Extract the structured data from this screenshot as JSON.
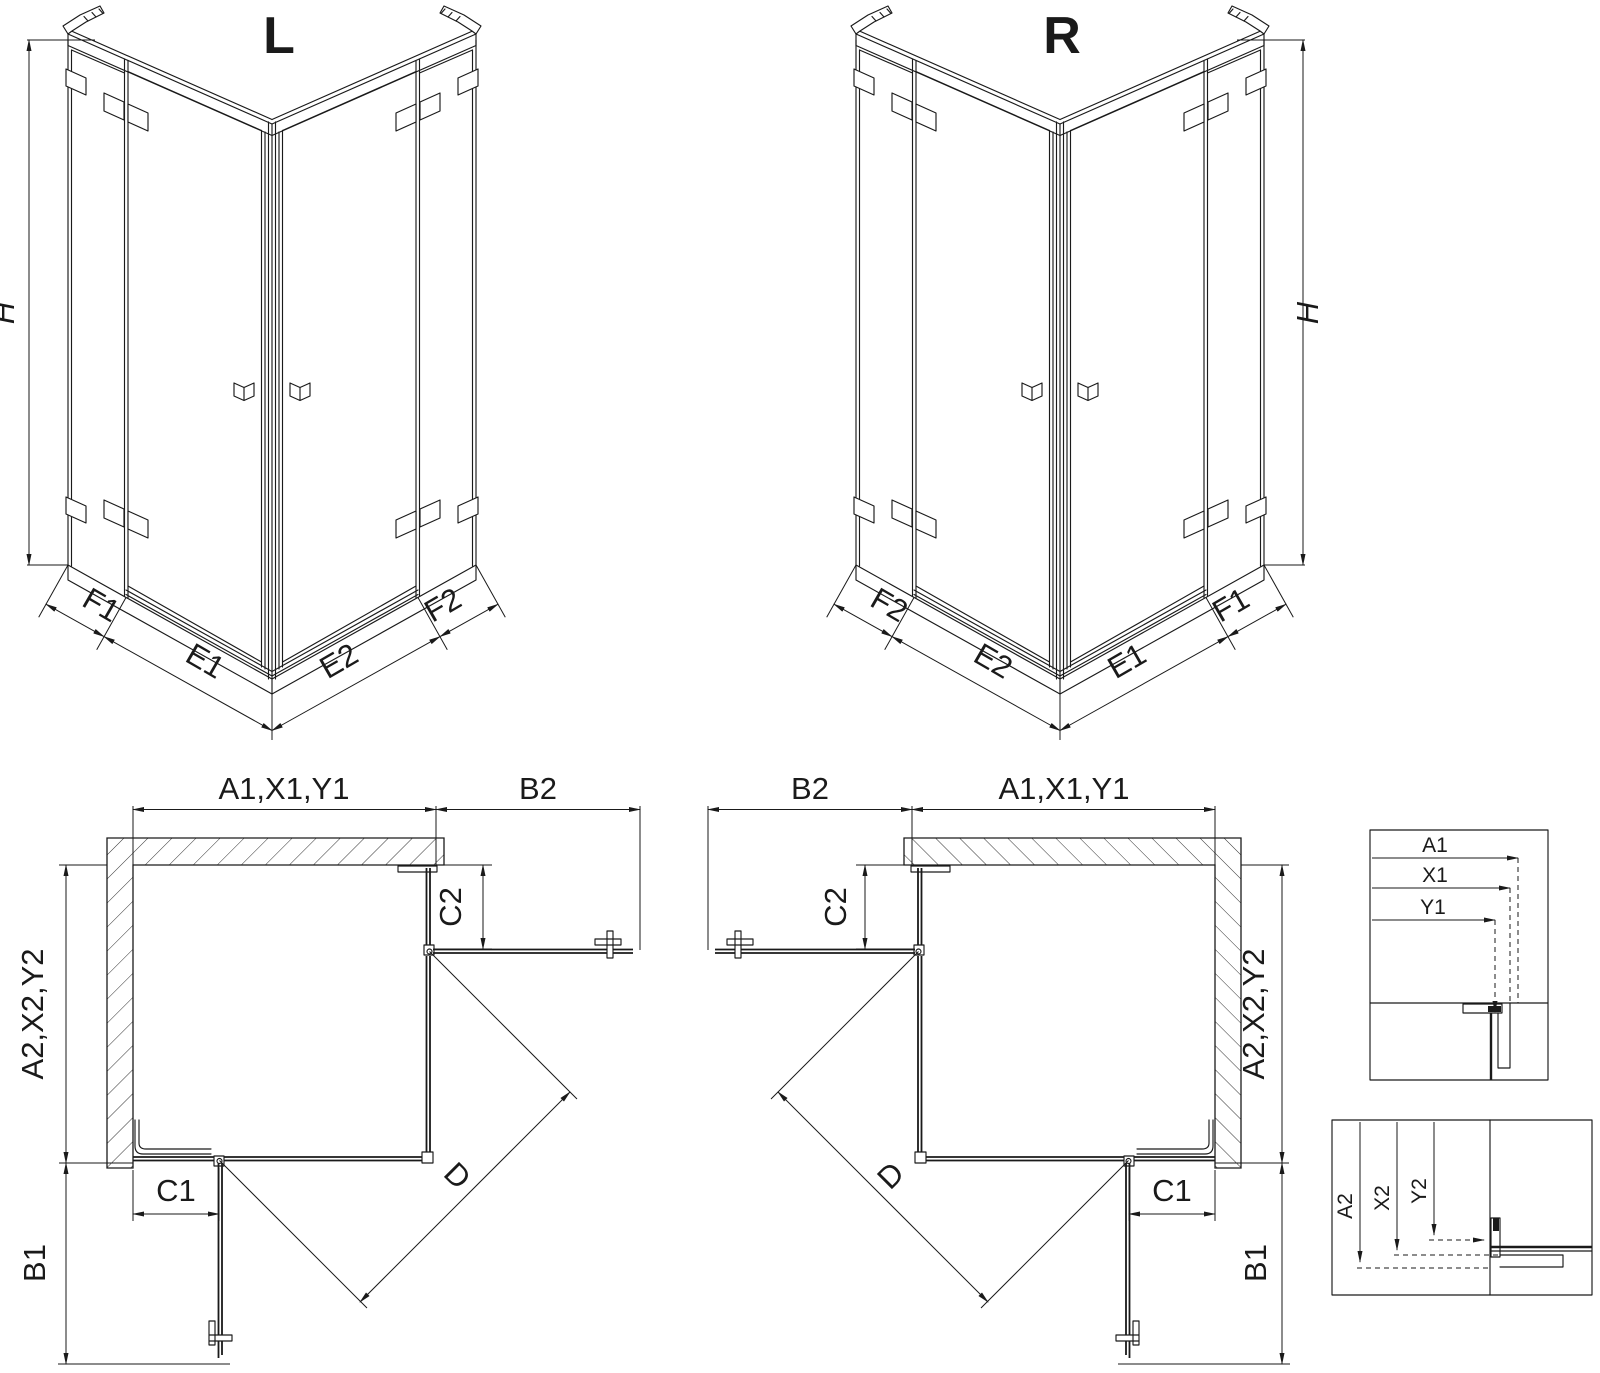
{
  "colors": {
    "ink": "#1a1a1a",
    "background": "#ffffff"
  },
  "drawing": {
    "variant_left": {
      "label": "L",
      "height": "H",
      "front_left_fixed": "F1",
      "front_left_door": "E1",
      "front_right_door": "E2",
      "front_right_fixed": "F2"
    },
    "variant_right": {
      "label": "R",
      "height": "H",
      "front_left_fixed": "F2",
      "front_left_door": "E2",
      "front_right_door": "E1",
      "front_right_fixed": "F1"
    },
    "plan": {
      "width_total": "A1,X1,Y1",
      "width_door": "B2",
      "depth_total": "A2,X2,Y2",
      "depth_door": "B1",
      "fixed_return_top": "C2",
      "fixed_return_side": "C1",
      "diagonal_entry": "D"
    },
    "detail_width": {
      "dims": [
        "A1",
        "X1",
        "Y1"
      ]
    },
    "detail_depth": {
      "dims": [
        "A2",
        "X2",
        "Y2"
      ]
    }
  }
}
